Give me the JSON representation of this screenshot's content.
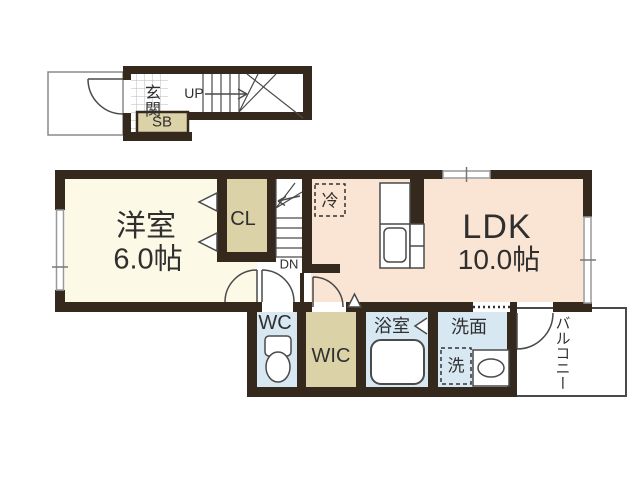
{
  "floorplan": {
    "colors": {
      "wall": "#35291e",
      "room_cream": "#fcf9e6",
      "room_peach": "#fae4d3",
      "room_beige": "#dcd2a8",
      "room_blue": "#d8e8f3",
      "outline": "#4a4a4a",
      "window_gray": "#999999",
      "tile_line": "#b8b8b8",
      "text": "#2f2f2f"
    },
    "entrance": {
      "genkan_label": "玄関",
      "stairs_up_label": "UP",
      "shoebox_label": "SB"
    },
    "rooms": {
      "western": {
        "label": "洋室",
        "size": "6.0帖"
      },
      "ldk": {
        "label": "LDK",
        "size": "10.0帖"
      },
      "closet": {
        "label": "CL"
      },
      "stairs_down": {
        "label": "DN"
      },
      "fridge": {
        "label": "冷"
      },
      "wc": {
        "label": "WC"
      },
      "wic": {
        "label": "WIC"
      },
      "bath": {
        "label": "浴室"
      },
      "washroom": {
        "label": "洗面"
      },
      "washer": {
        "label": "洗"
      },
      "balcony": {
        "label": "バルコニー"
      }
    }
  }
}
